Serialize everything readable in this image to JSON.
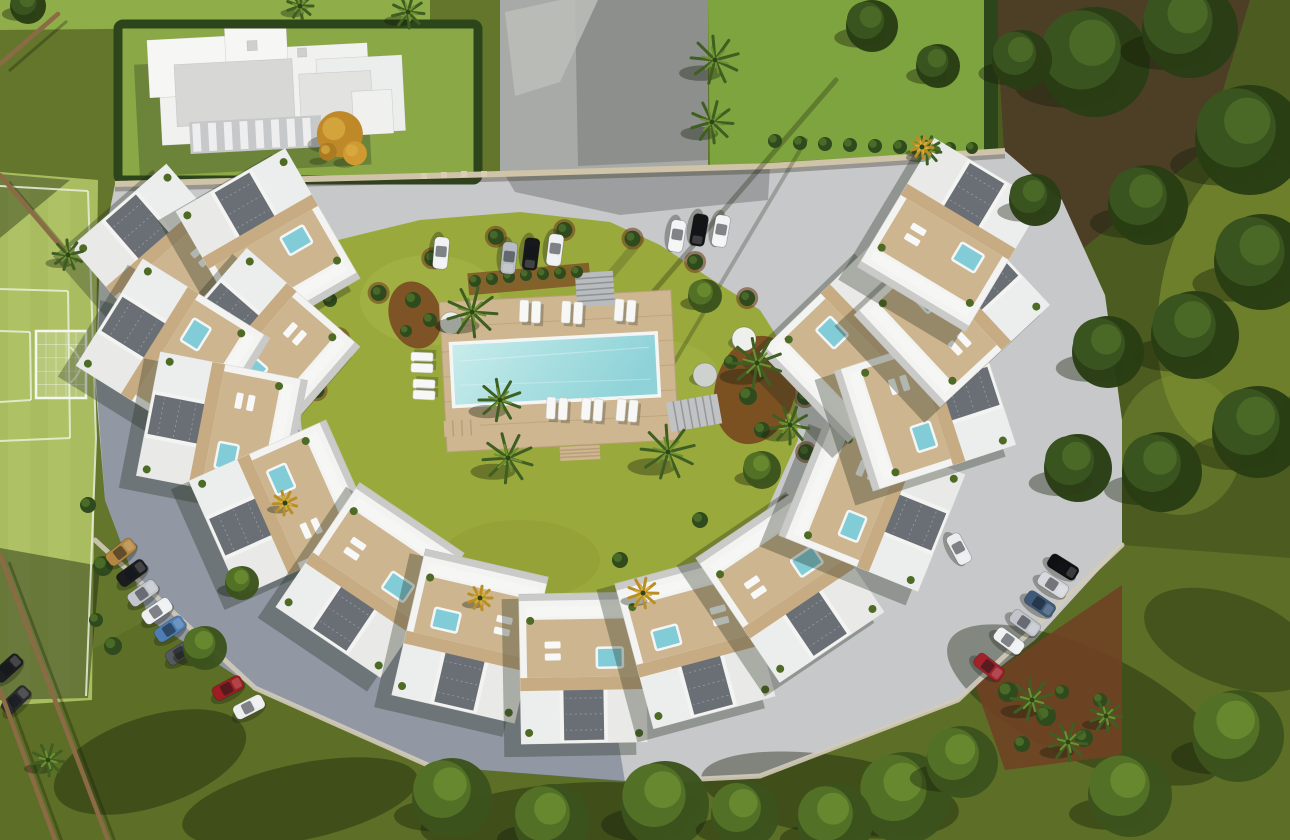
{
  "meta": {
    "scene": "aerial-3d-render-residential-complex",
    "canvas_w": 1290,
    "canvas_h": 840
  },
  "palette": {
    "grass_dark": "#5d6f26",
    "grass_base": "#64762b",
    "grass_bright": "#8fae49",
    "garden": "#9aa93c",
    "pitch": "#a9bd60",
    "pitch_line": "#e9eeda",
    "pavement": "#c6c8c9",
    "pavement_shade": "#5c6880",
    "building": "#f3f3f1",
    "terrace": "#cdb68f",
    "pergola": "#c7ab82",
    "gravel": "#6a6f76",
    "pool_light": "#c9eceb",
    "pool_deep": "#8fd3d8",
    "jacuzzi": "#82ccd8",
    "deck": "#cdb690",
    "mulch": "#7a4a24",
    "hedge": "#2c451b",
    "wall": "#cfc3a8",
    "curb": "#d2cbba",
    "tree_dark": "#293d14",
    "tree_mid": "#3c531d",
    "palm": "#3f5e22",
    "palm_yellow": "#b98f25",
    "trunk": "#8a6b45"
  },
  "zones": [
    {
      "n": "base-grass",
      "r": 1,
      "x": 0,
      "y": 0,
      "w": 1290,
      "h": 840,
      "f": "#64762b"
    },
    {
      "n": "bottom-grass",
      "p": "0,700 150,618 430,766 700,780 958,700 1122,545 1290,558 1290,840 0,840",
      "f": "#5d6f26"
    },
    {
      "n": "top-left-lawn",
      "p": "0,0 430,0 430,26 0,30",
      "f": "#8fae49"
    },
    {
      "n": "football-pitch",
      "p": "0,172 98,180 92,700 0,706",
      "f": "#a9bd60"
    },
    {
      "n": "pitch-stripe",
      "r": 1,
      "x": 8,
      "y": 186,
      "w": 22,
      "h": 510,
      "f": "#b6c96e",
      "o": 0.35
    },
    {
      "n": "pitch-stripe",
      "r": 1,
      "x": 48,
      "y": 188,
      "w": 22,
      "h": 508,
      "f": "#b6c96e",
      "o": 0.35
    },
    {
      "n": "pitch-shadow",
      "p": "0,174 70,180 0,238",
      "f": "rgba(25,35,12,0.4)"
    },
    {
      "n": "neighbor-plot-lawn",
      "p": "118,24 478,22 478,178 118,182",
      "f": "#8aa946"
    },
    {
      "n": "concrete-plot",
      "p": "500,0 708,0 708,165 500,172",
      "f": "#a8aaa7"
    },
    {
      "n": "concrete-plot-dark",
      "p": "575,0 708,0 708,160 578,166",
      "f": "#8d8f8c"
    },
    {
      "n": "concrete-path",
      "p": "505,12 560,0 598,0 560,82 515,96",
      "f": "#bcbeba",
      "o": 0.85
    },
    {
      "n": "top-right-lawn",
      "p": "708,0 988,0 986,150 710,166",
      "f": "#7ea43f"
    },
    {
      "n": "forest-ground",
      "p": "988,0 1290,0 1290,558 1122,545 1060,420 1005,240 988,150",
      "f": "#4c5c20"
    },
    {
      "n": "forest-soil",
      "p": "995,0 1250,0 1205,150 1075,255 1005,165",
      "f": "rgba(76,58,40,0.85)"
    },
    {
      "n": "boundary-hedge",
      "r": 1,
      "x": 984,
      "y": 0,
      "w": 14,
      "h": 152,
      "f": "#2c451b"
    },
    {
      "n": "forest-sunlit-patch",
      "e": 1,
      "cx": 1240,
      "cy": 300,
      "rx": 80,
      "ry": 150,
      "rot": 10,
      "f": "#8a9c35",
      "o": 0.55
    },
    {
      "n": "forest-sunlit-patch",
      "e": 1,
      "cx": 1180,
      "cy": 445,
      "rx": 62,
      "ry": 70,
      "rot": 0,
      "f": "#7d9032",
      "o": 0.45
    },
    {
      "n": "pavement",
      "p": "115,184 500,174 770,166 1005,151 1062,200 1105,295 1122,420 1122,545 1035,640 958,700 760,776 640,782 430,766 255,688 150,620 105,500 95,380 100,260",
      "f": "#c6c8c9"
    },
    {
      "n": "pavement-shadow",
      "p": "100,300 230,340 330,470 470,610 610,690 625,782 430,766 255,688 150,620 105,500 96,380",
      "f": "#5c6880",
      "o": 0.5
    },
    {
      "n": "pitch-shadow",
      "p": "0,548 100,566 88,698 0,700",
      "f": "rgba(25,35,12,0.45)"
    },
    {
      "n": "tree-shadow",
      "e": 1,
      "cx": 300,
      "cy": 802,
      "rx": 120,
      "ry": 38,
      "rot": -12,
      "f": "rgba(22,30,10,0.4)"
    },
    {
      "n": "tree-shadow",
      "e": 1,
      "cx": 560,
      "cy": 818,
      "rx": 140,
      "ry": 34,
      "rot": -5,
      "f": "rgba(22,30,10,0.4)"
    },
    {
      "n": "tree-shadow",
      "e": 1,
      "cx": 830,
      "cy": 795,
      "rx": 130,
      "ry": 40,
      "rot": 8,
      "f": "rgba(22,30,10,0.4)"
    },
    {
      "n": "tree-shadow",
      "e": 1,
      "cx": 1085,
      "cy": 705,
      "rx": 150,
      "ry": 55,
      "rot": 25,
      "f": "rgba(22,30,10,0.38)"
    },
    {
      "n": "tree-shadow",
      "e": 1,
      "cx": 150,
      "cy": 762,
      "rx": 100,
      "ry": 45,
      "rot": -18,
      "f": "rgba(22,30,10,0.4)"
    },
    {
      "n": "tree-shadow",
      "e": 1,
      "cx": 1230,
      "cy": 640,
      "rx": 90,
      "ry": 45,
      "rot": 20,
      "f": "rgba(22,30,10,0.33)"
    },
    {
      "n": "site-driveway",
      "p": "505,175 770,167 768,200 620,215 515,192",
      "f": "#97999a",
      "o": 0.9
    },
    {
      "n": "garden-lawn",
      "p": "330,242 420,220 520,212 610,222 660,245 705,275 760,310 795,365 798,440 760,525 690,585 600,620 500,622 410,590 345,530 305,460 296,375 305,300",
      "f": "#9aa93c"
    },
    {
      "n": "garden-light",
      "e": 1,
      "cx": 430,
      "cy": 300,
      "rx": 70,
      "ry": 45,
      "rot": 0,
      "f": "#a8b748",
      "o": 0.5
    },
    {
      "n": "garden-light",
      "e": 1,
      "cx": 660,
      "cy": 380,
      "rx": 60,
      "ry": 40,
      "rot": 0,
      "f": "#a4b344",
      "o": 0.45
    },
    {
      "n": "garden-light",
      "e": 1,
      "cx": 520,
      "cy": 560,
      "rx": 80,
      "ry": 40,
      "rot": 0,
      "f": "#8d9c34",
      "o": 0.5
    },
    {
      "n": "mulch-bed",
      "e": 1,
      "cx": 415,
      "cy": 315,
      "rx": 26,
      "ry": 34,
      "rot": -15,
      "f": "#7a4a24",
      "o": 0.9
    },
    {
      "n": "mulch-bed",
      "e": 1,
      "cx": 755,
      "cy": 390,
      "rx": 40,
      "ry": 55,
      "rot": 15,
      "f": "#76441f",
      "o": 0.88
    },
    {
      "n": "mulch-bed",
      "r": 1,
      "x": 468,
      "y": 268,
      "w": 122,
      "h": 22,
      "rot": -5,
      "f": "#7a4a24",
      "o": 0.75
    },
    {
      "n": "mulch-bed",
      "p": "975,685 1122,585 1122,755 1005,770",
      "f": "#6f4224",
      "o": 0.92
    }
  ],
  "pitch": {
    "lines": [
      "0,186 88,191",
      "88,191 96,438 86,696",
      "0,289 68,291",
      "68,291 70,438",
      "70,438 0,441",
      "0,331 30,332",
      "30,332 31,400",
      "31,400 0,402"
    ],
    "arc": "M70,347 Q91,365 70,383",
    "goal": {
      "x": 36,
      "y": 331,
      "w": 50,
      "h": 67
    }
  },
  "villa": {
    "rot": -3,
    "cx": 265,
    "cy": 100,
    "shadow": {
      "x": 136,
      "y": 58,
      "w": 232,
      "h": 112
    },
    "blocks": [
      [
        160,
        48,
        210,
        92,
        "#f1f1ef"
      ],
      [
        150,
        34,
        92,
        58,
        "#f6f6f4"
      ],
      [
        318,
        62,
        86,
        76,
        "#eceded"
      ],
      [
        228,
        26,
        62,
        42,
        "#f6f6f4"
      ],
      [
        176,
        60,
        118,
        62,
        "#d7d8d6"
      ],
      [
        300,
        76,
        72,
        52,
        "#e2e3e1"
      ],
      [
        352,
        96,
        40,
        44,
        "#f0f0ee"
      ],
      [
        250,
        40,
        10,
        10,
        "#cfd0ce"
      ],
      [
        300,
        50,
        9,
        9,
        "#cfd0ce"
      ]
    ],
    "awning": {
      "x": 188,
      "y": 118,
      "w": 132,
      "h": 32,
      "base": "#c6c8ca",
      "stripe": "#f2f2f2",
      "n": 8
    },
    "orange_tree": [
      [
        338,
        138,
        23,
        "#bf8929"
      ],
      [
        352,
        158,
        12,
        "#cf9a30"
      ],
      [
        325,
        155,
        9,
        "#ab7b22"
      ]
    ],
    "hedge": {
      "x": 118,
      "y": 24,
      "w": 360,
      "h": 156
    }
  },
  "wall": {
    "path": "M115,184 L500,174 L770,166 L1005,151",
    "posts": [
      [
        424,
        176
      ],
      [
        444,
        175
      ],
      [
        464,
        174
      ],
      [
        484,
        174
      ]
    ]
  },
  "curbs": [
    "95,540 255,688 430,766",
    "640,782 760,776 958,700 1122,545"
  ],
  "garden_shadows": [
    [
      836,
      80,
      560,
      400,
      5,
      0.3
    ],
    [
      640,
      240,
      468,
      444,
      9,
      0.18
    ],
    [
      806,
      140,
      640,
      420,
      4,
      0.25
    ]
  ],
  "pool": {
    "deck": {
      "x": 443,
      "y": 296,
      "w": 232,
      "h": 150
    },
    "basin": {
      "x": 452,
      "y": 338,
      "w": 206,
      "h": 63
    },
    "rot": -3,
    "px": 559,
    "py": 371
  },
  "stairs": [
    {
      "x": 576,
      "y": 272,
      "w": 38,
      "h": 34,
      "rot": -4,
      "n": 6,
      "dir": "h",
      "base": "#b9bcbe",
      "stripe": "#8e9294"
    },
    {
      "x": 668,
      "y": 398,
      "w": 52,
      "h": 30,
      "rot": -10,
      "n": 7,
      "dir": "v",
      "base": "#c0c2c4",
      "stripe": "#94989b"
    },
    {
      "x": 444,
      "y": 420,
      "w": 36,
      "h": 16,
      "rot": -3,
      "n": 4,
      "dir": "v",
      "base": "#cdb690",
      "stripe": "#b89f79"
    },
    {
      "x": 560,
      "y": 446,
      "w": 40,
      "h": 14,
      "rot": -3,
      "n": 4,
      "dir": "h",
      "base": "#cdb690",
      "stripe": "#b89f79"
    }
  ],
  "loungers": [
    [
      524,
      311,
      2
    ],
    [
      536,
      312,
      2
    ],
    [
      566,
      312,
      3
    ],
    [
      578,
      313,
      3
    ],
    [
      619,
      310,
      4
    ],
    [
      631,
      311,
      4
    ],
    [
      551,
      408,
      3
    ],
    [
      563,
      409,
      3
    ],
    [
      586,
      409,
      4
    ],
    [
      598,
      410,
      4
    ],
    [
      621,
      410,
      5
    ],
    [
      633,
      411,
      5
    ],
    [
      422,
      357,
      -88
    ],
    [
      422,
      368,
      -88
    ],
    [
      424,
      384,
      -87
    ],
    [
      424,
      395,
      -87
    ]
  ],
  "discs": [
    [
      451,
      323,
      11,
      "#eceee9"
    ],
    [
      744,
      339,
      12,
      "#eef0ec"
    ],
    [
      705,
      375,
      12,
      "#ced2ce"
    ]
  ],
  "planter_ring": {
    "cx": 560,
    "cy": 428,
    "rx": 248,
    "ry": 198,
    "a0": 95,
    "a1": 415,
    "step": 16
  },
  "bushes": [
    [
      775,
      141,
      7
    ],
    [
      800,
      143,
      7
    ],
    [
      825,
      144,
      7
    ],
    [
      850,
      145,
      7
    ],
    [
      875,
      146,
      7
    ],
    [
      900,
      147,
      7
    ],
    [
      925,
      147,
      7
    ],
    [
      950,
      148,
      6
    ],
    [
      972,
      148,
      6
    ],
    [
      475,
      281,
      6
    ],
    [
      492,
      279,
      6
    ],
    [
      509,
      277,
      6
    ],
    [
      526,
      275,
      6
    ],
    [
      543,
      274,
      6
    ],
    [
      560,
      273,
      6
    ],
    [
      577,
      272,
      6
    ],
    [
      748,
      396,
      9
    ],
    [
      774,
      356,
      8
    ],
    [
      731,
      362,
      7
    ],
    [
      762,
      430,
      8
    ],
    [
      413,
      300,
      8
    ],
    [
      430,
      320,
      7
    ],
    [
      406,
      331,
      6
    ],
    [
      1008,
      692,
      10
    ],
    [
      1046,
      716,
      10
    ],
    [
      1084,
      738,
      9
    ],
    [
      1062,
      692,
      7
    ],
    [
      1022,
      744,
      8
    ],
    [
      1100,
      700,
      7
    ],
    [
      103,
      566,
      10
    ],
    [
      113,
      646,
      9
    ],
    [
      96,
      620,
      7
    ],
    [
      88,
      505,
      8
    ],
    [
      350,
      520,
      8
    ],
    [
      390,
      560,
      7
    ],
    [
      620,
      560,
      8
    ],
    [
      700,
      520,
      8
    ],
    [
      330,
      300,
      7
    ]
  ],
  "units": [
    [
      168,
      262,
      -41
    ],
    [
      268,
      245,
      -30
    ],
    [
      262,
      345,
      -49
    ],
    [
      173,
      352,
      -58
    ],
    [
      222,
      428,
      -79
    ],
    [
      283,
      508,
      -114
    ],
    [
      370,
      580,
      -146
    ],
    [
      470,
      636,
      -167
    ],
    [
      583,
      668,
      179
    ],
    [
      695,
      640,
      165
    ],
    [
      790,
      585,
      146
    ],
    [
      872,
      505,
      112
    ],
    [
      858,
      345,
      46
    ],
    [
      925,
      408,
      72
    ],
    [
      952,
      310,
      47
    ],
    [
      950,
      235,
      31
    ]
  ],
  "cars": [
    [
      441,
      253,
      95,
      "#f1f2f3"
    ],
    [
      509,
      258,
      96,
      "#b7bcc3"
    ],
    [
      531,
      254,
      97,
      "#17181a"
    ],
    [
      555,
      250,
      97,
      "#eef0f1"
    ],
    [
      677,
      236,
      99,
      "#f3f4f5"
    ],
    [
      699,
      230,
      100,
      "#131416"
    ],
    [
      721,
      231,
      100,
      "#f3f4f5"
    ],
    [
      121,
      552,
      -38,
      "#b3873f"
    ],
    [
      132,
      573,
      -36,
      "#1b1c1e"
    ],
    [
      143,
      593,
      -35,
      "#c3c7cd"
    ],
    [
      157,
      611,
      -34,
      "#edeff1"
    ],
    [
      170,
      629,
      -33,
      "#4c7eb4"
    ],
    [
      181,
      652,
      -32,
      "#55585e"
    ],
    [
      228,
      688,
      -28,
      "#9e1d22"
    ],
    [
      249,
      707,
      -27,
      "#eceef0"
    ],
    [
      8,
      668,
      -42,
      "#1d1e20"
    ],
    [
      16,
      700,
      -44,
      "#2c2d30"
    ],
    [
      959,
      549,
      62,
      "#ebedef"
    ],
    [
      1063,
      567,
      32,
      "#0f1012"
    ],
    [
      1053,
      585,
      33,
      "#d5d8dc"
    ],
    [
      1040,
      604,
      34,
      "#3e5979"
    ],
    [
      1025,
      623,
      35,
      "#c1c5cb"
    ],
    [
      1009,
      641,
      36,
      "#eef0f2"
    ],
    [
      989,
      667,
      38,
      "#a2222a"
    ]
  ],
  "trunks": [
    [
      68,
      255,
      0,
      175
    ],
    [
      0,
      555,
      108,
      840
    ],
    [
      0,
      690,
      55,
      840
    ],
    [
      0,
      64,
      58,
      14
    ]
  ],
  "palms": {
    "green": [
      [
        715,
        60,
        24
      ],
      [
        712,
        122,
        21
      ],
      [
        472,
        312,
        25
      ],
      [
        500,
        400,
        21
      ],
      [
        508,
        458,
        25
      ],
      [
        668,
        452,
        27
      ],
      [
        757,
        363,
        25
      ],
      [
        790,
        425,
        19
      ],
      [
        927,
        150,
        14
      ],
      [
        1032,
        700,
        21
      ],
      [
        1068,
        742,
        19
      ],
      [
        1106,
        716,
        16
      ],
      [
        68,
        255,
        15
      ],
      [
        48,
        760,
        16
      ],
      [
        408,
        12,
        16
      ],
      [
        300,
        6,
        13
      ]
    ],
    "yellow": [
      [
        643,
        593,
        15
      ],
      [
        480,
        598,
        12
      ],
      [
        285,
        503,
        12
      ],
      [
        922,
        147,
        11
      ]
    ]
  },
  "trees": [
    [
      1095,
      62,
      55,
      "d"
    ],
    [
      1190,
      30,
      48,
      "d"
    ],
    [
      1250,
      140,
      55,
      "d"
    ],
    [
      1148,
      205,
      40,
      "d"
    ],
    [
      1262,
      262,
      48,
      "d"
    ],
    [
      1195,
      335,
      44,
      "d"
    ],
    [
      1108,
      352,
      36,
      "d"
    ],
    [
      1258,
      432,
      46,
      "d"
    ],
    [
      1162,
      472,
      40,
      "d"
    ],
    [
      1078,
      468,
      34,
      "d"
    ],
    [
      1022,
      60,
      30,
      "d"
    ],
    [
      1035,
      200,
      26,
      "d"
    ],
    [
      872,
      26,
      26,
      "d"
    ],
    [
      938,
      66,
      22,
      "d"
    ],
    [
      28,
      6,
      18,
      "d"
    ],
    [
      1238,
      736,
      46,
      "m"
    ],
    [
      1130,
      795,
      42,
      "m"
    ],
    [
      905,
      798,
      46,
      "m"
    ],
    [
      962,
      762,
      36,
      "m"
    ],
    [
      835,
      822,
      38,
      "m"
    ],
    [
      665,
      805,
      44,
      "m"
    ],
    [
      552,
      822,
      38,
      "m"
    ],
    [
      452,
      798,
      40,
      "m"
    ],
    [
      745,
      815,
      34,
      "m"
    ],
    [
      205,
      648,
      22,
      "m"
    ],
    [
      242,
      583,
      17,
      "m"
    ],
    [
      705,
      296,
      17,
      "m"
    ],
    [
      762,
      470,
      19,
      "m"
    ]
  ]
}
